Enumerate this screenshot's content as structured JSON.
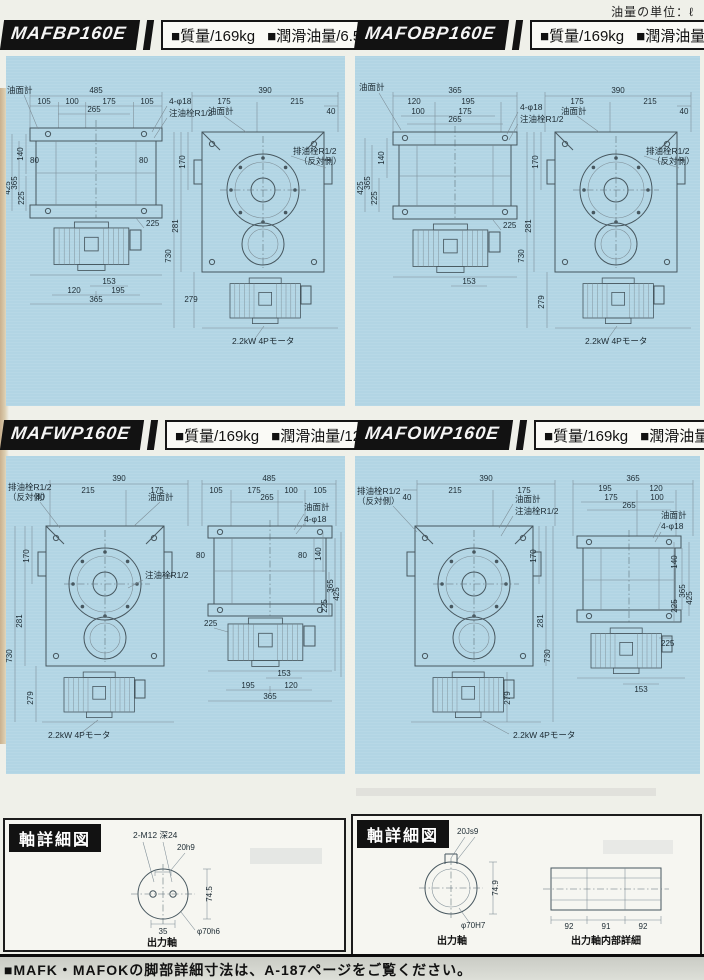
{
  "page": {
    "unit_note": "油量の単位：ℓ",
    "footer": "■MAFK・MAFOKの脚部詳細寸法は、A-187ページをご覧ください。",
    "colors": {
      "panel_blue": "#b2d5e4",
      "badge_black": "#121212",
      "paper": "#eff0e9"
    }
  },
  "panels": [
    {
      "model": "MAFBP160E",
      "mass": "■質量/169kg",
      "oil": "■潤滑油量/6.5",
      "flat": {
        "gauge": "油面計",
        "total": "485",
        "s1": "105",
        "s2": "100",
        "s3": "175",
        "s4": "105",
        "inner": "265",
        "bolt": "4-φ18",
        "filler": "注油栓R1/2",
        "v140": "140",
        "v80": "80",
        "e80b": "80",
        "v425": "425",
        "v365": "365",
        "v225": "225",
        "m225": "225",
        "m153": "153",
        "m120": "120",
        "m195": "195",
        "m365": "365"
      },
      "round": {
        "total": "390",
        "s1": "175",
        "s2": "215",
        "off": "40",
        "gauge": "油面計",
        "drain": "排油栓R1/2",
        "drain2": "（反対側）",
        "v170": "170",
        "v281": "281",
        "v730": "730",
        "v279": "279",
        "motor": "2.2kW 4Pモータ"
      }
    },
    {
      "model": "MAFOBP160E",
      "mass": "■質量/169kg",
      "oil": "■潤滑油量/6.5",
      "flat": {
        "gauge": "油面計",
        "total": "365",
        "s1": "120",
        "s2": "195",
        "s3": "100",
        "s4": "175",
        "inner": "265",
        "bolt": "4-φ18",
        "filler": "注油栓R1/2",
        "v140": "140",
        "v425": "425",
        "v365": "365",
        "v225": "225",
        "m225": "225",
        "m153": "153"
      },
      "round": {
        "total": "390",
        "s1": "175",
        "s2": "215",
        "off": "40",
        "gauge": "油面計",
        "drain": "排油栓R1/2",
        "drain2": "（反対側）",
        "v170": "170",
        "v281": "281",
        "v730": "730",
        "v279": "279",
        "motor": "2.2kW 4Pモータ"
      }
    },
    {
      "model": "MAFWP160E",
      "mass": "■質量/169kg",
      "oil": "■潤滑油量/12.5",
      "round": {
        "total": "390",
        "s1": "215",
        "s2": "175",
        "off": "40",
        "drain": "排油栓R1/2",
        "drain2": "（反対側）",
        "gauge": "油面計",
        "filler": "注油栓R1/2",
        "v170": "170",
        "v281": "281",
        "v730": "730",
        "v279": "279",
        "motor": "2.2kW 4Pモータ"
      },
      "flat": {
        "total": "485",
        "s1": "105",
        "s2": "175",
        "s3": "100",
        "s4": "105",
        "inner": "265",
        "gauge": "油面計",
        "bolt": "4-φ18",
        "e80a": "80",
        "e80b": "80",
        "v140": "140",
        "v225": "225",
        "v365": "365",
        "v425": "425",
        "m225": "225",
        "m153": "153",
        "m195": "195",
        "m120": "120",
        "m365": "365"
      }
    },
    {
      "model": "MAFOWP160E",
      "mass": "■質量/169kg",
      "oil": "■潤滑油量/12.5",
      "round": {
        "total": "390",
        "s1": "215",
        "s2": "175",
        "off": "40",
        "drain": "排油栓R1/2",
        "drain2": "（反対側）",
        "gauge": "油面計",
        "filler": "注油栓R1/2",
        "v170": "170",
        "v281": "281",
        "v730": "730",
        "v279": "279",
        "motor": "2.2kW 4Pモータ"
      },
      "flat": {
        "total": "365",
        "s1": "195",
        "s2": "120",
        "s3": "175",
        "s4": "100",
        "inner": "265",
        "gauge": "油面計",
        "bolt": "4-φ18",
        "v140": "140",
        "v225": "225",
        "v365": "365",
        "v425": "425",
        "m225": "225",
        "m153": "153"
      }
    }
  ],
  "shaft_left": {
    "title": "軸詳細図",
    "tap": "2-M12 深24",
    "key": "20h9",
    "height": "74.5",
    "width": "35",
    "dia": "φ70h6",
    "caption": "出力軸"
  },
  "shaft_right": {
    "title": "軸詳細図",
    "key": "20Js9",
    "height": "74.9",
    "dia": "φ70H7",
    "caption": "出力軸",
    "d92a": "92",
    "d91": "91",
    "d92b": "92",
    "caption2": "出力軸内部詳細"
  }
}
